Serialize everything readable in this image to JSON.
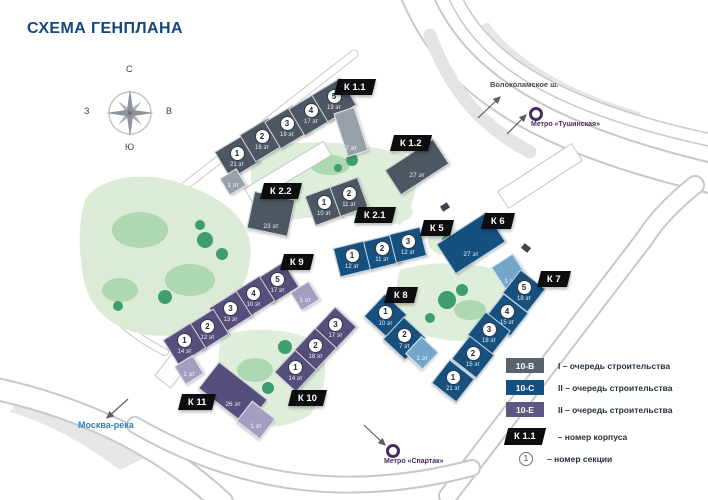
{
  "title": "СХЕМА ГЕНПЛАНА",
  "compass": {
    "north": "С",
    "south": "Ю",
    "west": "З",
    "east": "В"
  },
  "landmarks": {
    "highway": "Волоколамское ш.",
    "metro_tushinskaya": "Метро «Тушинская»",
    "metro_spartak": "Метро «Спартак»",
    "river": "Москва-река"
  },
  "colors": {
    "gray": "#4d5663",
    "gray_light": "#97a1ac",
    "blue": "#16507f",
    "blue_light": "#74a6ca",
    "purple": "#564f7b",
    "purple_light": "#a59ec1",
    "tag_bg": "#0c0d0f",
    "title": "#15477e",
    "metro": "#4b2a60",
    "river_label": "#2e7fbb",
    "green_light": "#dcebd6",
    "green_mid": "#aed8b2",
    "green_dark": "#3f9e6e"
  },
  "legend": {
    "items": [
      {
        "code": "10-В",
        "color": "#5a626d",
        "text": "I – очередь строительства"
      },
      {
        "code": "10-С",
        "color": "#16507f",
        "text": "II – очередь строительства"
      },
      {
        "code": "10-Е",
        "color": "#5f5781",
        "text": "II – очередь строительства"
      }
    ],
    "korpus": {
      "code": "К 1.1",
      "text": "– номер корпуса"
    },
    "section": {
      "code": "1",
      "text": "– номер секции"
    }
  },
  "buildings": [
    {
      "tag": "К 1.1",
      "color": "gray",
      "tag_pos": [
        336,
        79
      ],
      "sections": [
        {
          "num": "1",
          "floors": "21 эт",
          "x": 237,
          "y": 157,
          "w": 34,
          "h": 32,
          "r": -31
        },
        {
          "num": "2",
          "floors": "16 эт",
          "x": 262,
          "y": 140,
          "w": 34,
          "h": 32,
          "r": -31
        },
        {
          "num": "3",
          "floors": "19 эт",
          "x": 287,
          "y": 127,
          "w": 34,
          "h": 32,
          "r": -31
        },
        {
          "num": "4",
          "floors": "17 эт",
          "x": 311,
          "y": 114,
          "w": 34,
          "h": 32,
          "r": -31
        },
        {
          "num": "5",
          "floors": "19 эт",
          "x": 334,
          "y": 100,
          "w": 34,
          "h": 32,
          "r": -31
        },
        {
          "floors": "1 эт",
          "x": 233,
          "y": 182,
          "w": 20,
          "h": 20,
          "r": -31,
          "light": true
        },
        {
          "floors": "7 эт",
          "x": 351,
          "y": 132,
          "w": 22,
          "h": 46,
          "r": -18,
          "light": true
        }
      ]
    },
    {
      "tag": "К 1.2",
      "color": "gray",
      "tag_pos": [
        392,
        135
      ],
      "sections": [
        {
          "floors": "27 эт",
          "x": 417,
          "y": 167,
          "w": 58,
          "h": 30,
          "r": -33
        }
      ]
    },
    {
      "tag": "К 2.2",
      "color": "gray",
      "tag_pos": [
        262,
        183
      ],
      "sections": [
        {
          "floors": "23 эт",
          "x": 271,
          "y": 214,
          "w": 42,
          "h": 38,
          "r": 12
        }
      ]
    },
    {
      "tag": "К 2.1",
      "color": "gray",
      "tag_pos": [
        356,
        207
      ],
      "sections": [
        {
          "num": "1",
          "floors": "10 эт",
          "x": 324,
          "y": 206,
          "w": 30,
          "h": 32,
          "r": -20
        },
        {
          "num": "2",
          "floors": "11 эт",
          "x": 349,
          "y": 197,
          "w": 30,
          "h": 32,
          "r": -20
        }
      ]
    },
    {
      "tag": "К 5",
      "color": "blue",
      "tag_pos": [
        422,
        220
      ],
      "sections": [
        {
          "num": "1",
          "floors": "12 эт",
          "x": 352,
          "y": 259,
          "w": 32,
          "h": 30,
          "r": -14
        },
        {
          "num": "2",
          "floors": "11 эт",
          "x": 382,
          "y": 252,
          "w": 32,
          "h": 30,
          "r": -14
        },
        {
          "num": "3",
          "floors": "12 эт",
          "x": 408,
          "y": 245,
          "w": 32,
          "h": 30,
          "r": -14
        }
      ]
    },
    {
      "tag": "К 6",
      "color": "blue",
      "tag_pos": [
        483,
        213
      ],
      "sections": [
        {
          "floors": "27 эт",
          "x": 471,
          "y": 243,
          "w": 60,
          "h": 36,
          "r": -33
        },
        {
          "floors": "1 эт",
          "x": 510,
          "y": 273,
          "w": 26,
          "h": 30,
          "r": -33,
          "light": true
        }
      ]
    },
    {
      "tag": "К 7",
      "color": "blue",
      "tag_pos": [
        539,
        271
      ],
      "sections": [
        {
          "num": "5",
          "floors": "18 эт",
          "x": 524,
          "y": 291,
          "w": 32,
          "h": 30,
          "r": 38
        },
        {
          "num": "4",
          "floors": "15 эт",
          "x": 507,
          "y": 315,
          "w": 32,
          "h": 30,
          "r": 38
        },
        {
          "num": "3",
          "floors": "18 эт",
          "x": 489,
          "y": 333,
          "w": 32,
          "h": 30,
          "r": 38
        },
        {
          "num": "2",
          "floors": "15 эт",
          "x": 473,
          "y": 357,
          "w": 32,
          "h": 30,
          "r": 38
        },
        {
          "num": "1",
          "floors": "21 эт",
          "x": 453,
          "y": 381,
          "w": 32,
          "h": 30,
          "r": 38
        }
      ]
    },
    {
      "tag": "К 8",
      "color": "blue",
      "tag_pos": [
        386,
        287
      ],
      "sections": [
        {
          "num": "1",
          "floors": "10 эт",
          "x": 385,
          "y": 315,
          "w": 31,
          "h": 31,
          "r": 43
        },
        {
          "num": "2",
          "floors": "7 эт",
          "x": 404,
          "y": 338,
          "w": 31,
          "h": 31,
          "r": 43
        },
        {
          "floors": "1 эт",
          "x": 422,
          "y": 353,
          "w": 24,
          "h": 24,
          "r": 43,
          "light": true
        }
      ]
    },
    {
      "tag": "К 9",
      "color": "purple",
      "tag_pos": [
        282,
        254
      ],
      "sections": [
        {
          "num": "5",
          "floors": "17 эт",
          "x": 277,
          "y": 283,
          "w": 33,
          "h": 30,
          "r": -32
        },
        {
          "num": "4",
          "floors": "10 эт",
          "x": 253,
          "y": 297,
          "w": 33,
          "h": 30,
          "r": -32
        },
        {
          "num": "3",
          "floors": "13 эт",
          "x": 230,
          "y": 312,
          "w": 33,
          "h": 30,
          "r": -32
        },
        {
          "num": "2",
          "floors": "12 эт",
          "x": 207,
          "y": 330,
          "w": 33,
          "h": 30,
          "r": -32
        },
        {
          "num": "1",
          "floors": "14 эт",
          "x": 184,
          "y": 344,
          "w": 33,
          "h": 30,
          "r": -32
        },
        {
          "floors": "1 эт",
          "x": 305,
          "y": 296,
          "w": 22,
          "h": 22,
          "r": -32,
          "light": true
        },
        {
          "floors": "1 эт",
          "x": 189,
          "y": 370,
          "w": 22,
          "h": 22,
          "r": -32,
          "light": true
        }
      ]
    },
    {
      "tag": "К 10",
      "color": "purple",
      "tag_pos": [
        290,
        390
      ],
      "sections": [
        {
          "num": "3",
          "floors": "17 эт",
          "x": 335,
          "y": 328,
          "w": 31,
          "h": 30,
          "r": -47
        },
        {
          "num": "2",
          "floors": "18 эт",
          "x": 315,
          "y": 349,
          "w": 31,
          "h": 30,
          "r": -47
        },
        {
          "num": "1",
          "floors": "14 эт",
          "x": 295,
          "y": 371,
          "w": 31,
          "h": 30,
          "r": -47
        }
      ]
    },
    {
      "tag": "К 11",
      "color": "purple",
      "tag_pos": [
        180,
        394
      ],
      "sections": [
        {
          "floors": "26 эт",
          "x": 233,
          "y": 394,
          "w": 62,
          "h": 34,
          "r": 38
        },
        {
          "floors": "1 эт",
          "x": 256,
          "y": 420,
          "w": 30,
          "h": 26,
          "r": 38,
          "light": true
        }
      ]
    }
  ]
}
